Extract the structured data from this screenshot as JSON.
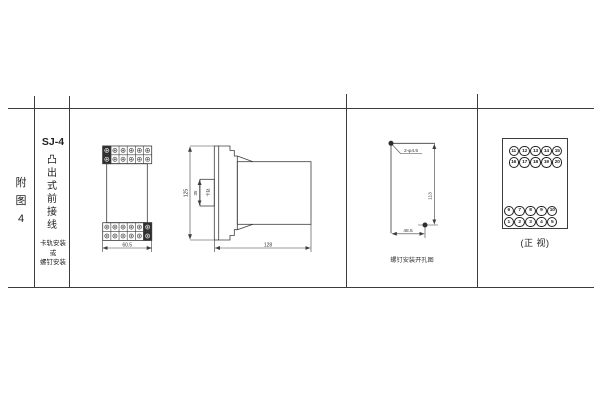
{
  "doc": {
    "figure_label_chars": [
      "附",
      "图",
      "4"
    ],
    "model": "SJ-4",
    "type_chars": [
      "凸",
      "出",
      "式",
      "前",
      "接",
      "线"
    ],
    "mount_lines": [
      "卡轨安装",
      "或",
      "螺钉安装"
    ]
  },
  "front_view": {
    "width_dim": "60.5"
  },
  "side_view": {
    "height_dim": "125",
    "slot_dim": "35",
    "slot_label": "卡轨",
    "depth_dim": "128"
  },
  "drill": {
    "hole_label": "2-φ4.5",
    "v_dim": "113",
    "h_dim": "48.5",
    "caption": "螺钉安装开孔图"
  },
  "terminals": {
    "caption": "(正 视)",
    "row1": [
      "11",
      "12",
      "13",
      "14",
      "15"
    ],
    "row2": [
      "16",
      "17",
      "18",
      "19",
      "20"
    ],
    "row3": [
      "6",
      "7",
      "8",
      "9",
      "10"
    ],
    "row4": [
      "1",
      "2",
      "3",
      "4",
      "5"
    ]
  },
  "colors": {
    "line": "#3c3c3c",
    "ink": "#333333"
  }
}
